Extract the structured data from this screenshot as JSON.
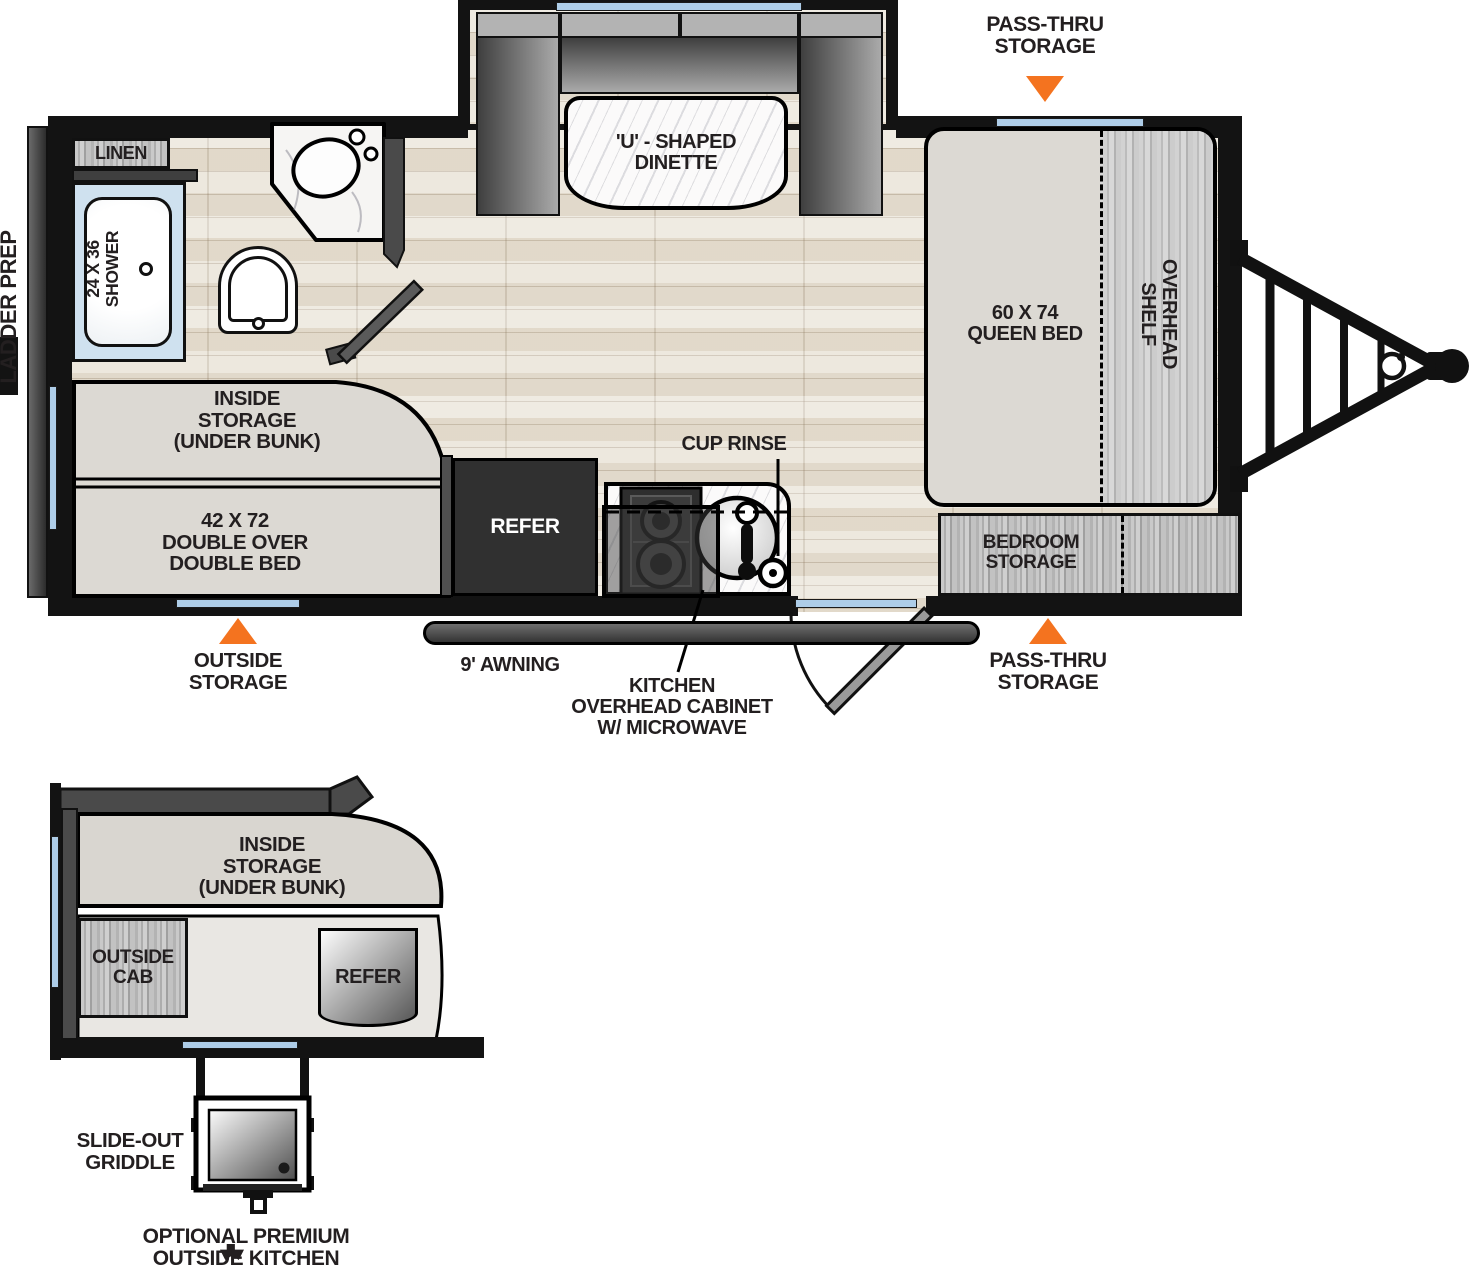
{
  "colors": {
    "accent_orange": "#f4731f",
    "window_blue": "#aecde8",
    "wall_black": "#131313",
    "label_ink": "#231f20"
  },
  "main_plan": {
    "ladder_prep": "LADDER PREP",
    "pass_thru_storage_top": "PASS-THRU\nSTORAGE",
    "dinette": "'U' - SHAPED\nDINETTE",
    "queen_bed": "60 X 74\nQUEEN BED",
    "overhead_shelf": "OVERHEAD\nSHELF",
    "linen": "LINEN",
    "shower": "24 X 36\nSHOWER",
    "inside_storage": "INSIDE\nSTORAGE\n(UNDER BUNK)",
    "double_bed": "42 X 72\nDOUBLE OVER\nDOUBLE BED",
    "refer": "REFER",
    "cup_rinse": "CUP RINSE",
    "kitchen_overhead": "KITCHEN\nOVERHEAD CABINET\nW/ MICROWAVE",
    "awning": "9' AWNING",
    "outside_storage": "OUTSIDE\nSTORAGE",
    "pass_thru_storage_bottom": "PASS-THRU\nSTORAGE",
    "bedroom_storage": "BEDROOM\nSTORAGE"
  },
  "outside_kitchen": {
    "inside_storage": "INSIDE\nSTORAGE\n(UNDER BUNK)",
    "outside_cab": "OUTSIDE\nCAB",
    "refer": "REFER",
    "slide_out_griddle": "SLIDE-OUT\nGRIDDLE",
    "caption": "OPTIONAL PREMIUM\nOUTSIDE KITCHEN"
  }
}
